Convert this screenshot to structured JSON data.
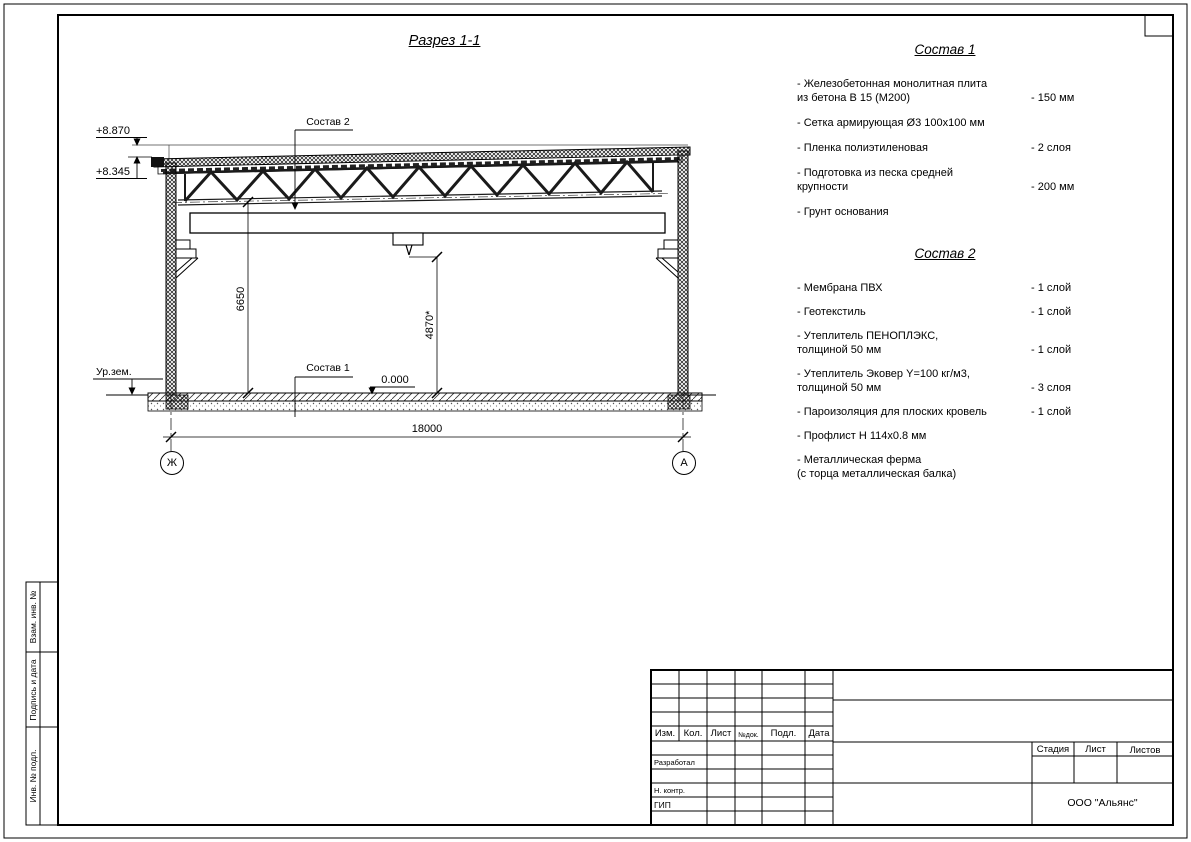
{
  "drawing": {
    "title": "Разрез 1-1",
    "axis_left": "Ж",
    "axis_right": "А",
    "dim_span": "18000",
    "dim_height_left": "6650",
    "dim_height_mid": "4870*",
    "elev_top": "+8.870",
    "elev_eaves": "+8.345",
    "elev_zero": "0.000",
    "ground_label": "Ур.зем.",
    "callout_roof": "Состав 2",
    "callout_floor": "Состав 1"
  },
  "spec1": {
    "title": "Состав 1",
    "items": [
      {
        "name": "- Железобетонная  монолитная плита\nиз бетона В 15 (М200)",
        "value": "- 150 мм"
      },
      {
        "name": "- Сетка армирующая Ø3 100х100 мм",
        "value": ""
      },
      {
        "name": "- Пленка полиэтиленовая",
        "value": "- 2 слоя"
      },
      {
        "name": "- Подготовка из песка средней\nкрупности",
        "value": "- 200 мм"
      },
      {
        "name": "- Грунт основания",
        "value": ""
      }
    ]
  },
  "spec2": {
    "title": "Состав 2",
    "items": [
      {
        "name": "- Мембрана ПВХ",
        "value": "- 1 слой"
      },
      {
        "name": "- Геотекстиль",
        "value": "- 1 слой"
      },
      {
        "name": "- Утеплитель ПЕНОПЛЭКС,\nтолщиной 50 мм",
        "value": "- 1 слой"
      },
      {
        "name": "- Утеплитель Эковер Y=100 кг/м3,\nтолщиной 50 мм",
        "value": "- 3 слоя"
      },
      {
        "name": "- Пароизоляция для плоских кровель",
        "value": "- 1 слой"
      },
      {
        "name": "- Профлист Н 114х0.8 мм",
        "value": ""
      },
      {
        "name": "- Металлическая ферма\n(с торца металлическая балка)",
        "value": ""
      }
    ]
  },
  "titleblock": {
    "col_izm": "Изм.",
    "col_kol": "Кол.",
    "col_list": "Лист",
    "col_ndok": "№док.",
    "col_podp": "Подл.",
    "col_data": "Дата",
    "role_developed": "Разработал",
    "role_ncontr": "Н. контр.",
    "role_gip": "ГИП",
    "stage": "Стадия",
    "sheet": "Лист",
    "sheets": "Листов",
    "company": "ООО \"Альянс\""
  },
  "side": {
    "label_vzam": "Взам. инв. №",
    "label_podpis": "Подпись и дата",
    "label_inv": "Инв. № подл."
  }
}
